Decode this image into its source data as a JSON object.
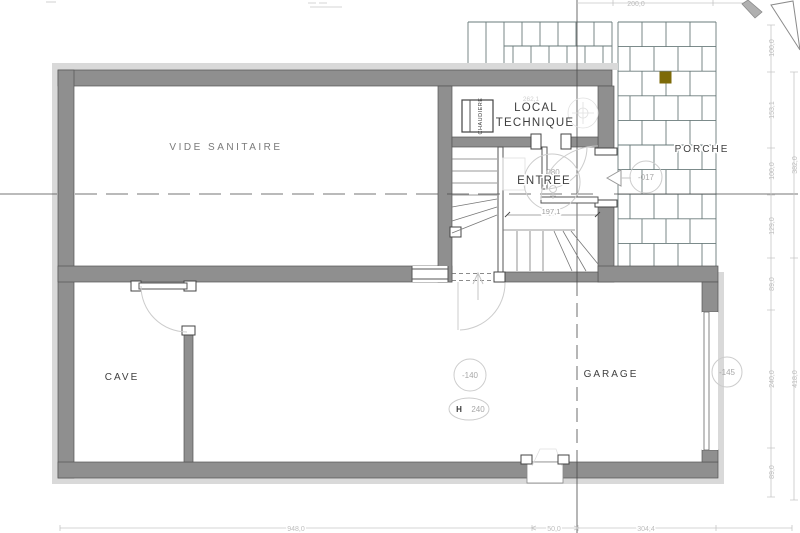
{
  "plan": {
    "rooms": {
      "vide_sanitaire": "VIDE SANITAIRE",
      "local_technique_line1": "LOCAL",
      "local_technique_line2": "TECHNIQUE",
      "entree": "ENTREE",
      "porche": "PORCHE",
      "cave": "CAVE",
      "garage": "GARAGE"
    },
    "equipment": {
      "boiler": "CHAUDIERE"
    },
    "levels": {
      "porch_level": "-017",
      "basement_level": "-140",
      "exterior_level": "-145",
      "ceiling_height_label": "H",
      "ceiling_height_value": "240",
      "entry_door_width": "080"
    },
    "dimensions": {
      "top_width": "200,0",
      "hall_width": "197,1",
      "local_technique_width": "262,1",
      "right_inner": [
        "100,0",
        "153,1",
        "100,0",
        "129,0",
        "89,0",
        "240,0",
        "89,0"
      ],
      "right_outer": [
        "382,0",
        "418,0"
      ],
      "bottom": [
        "948,0",
        "50,0",
        "304,4"
      ]
    },
    "colors": {
      "wall": "#8f8f8f",
      "wall_edge": "#555555",
      "insulation_band": "#d9d9d9",
      "tile_line": "#6a7b7b",
      "accent_tile": "#7d6a08",
      "dim_text": "#bdbdbd",
      "label_text": "#3f3f3f"
    }
  }
}
